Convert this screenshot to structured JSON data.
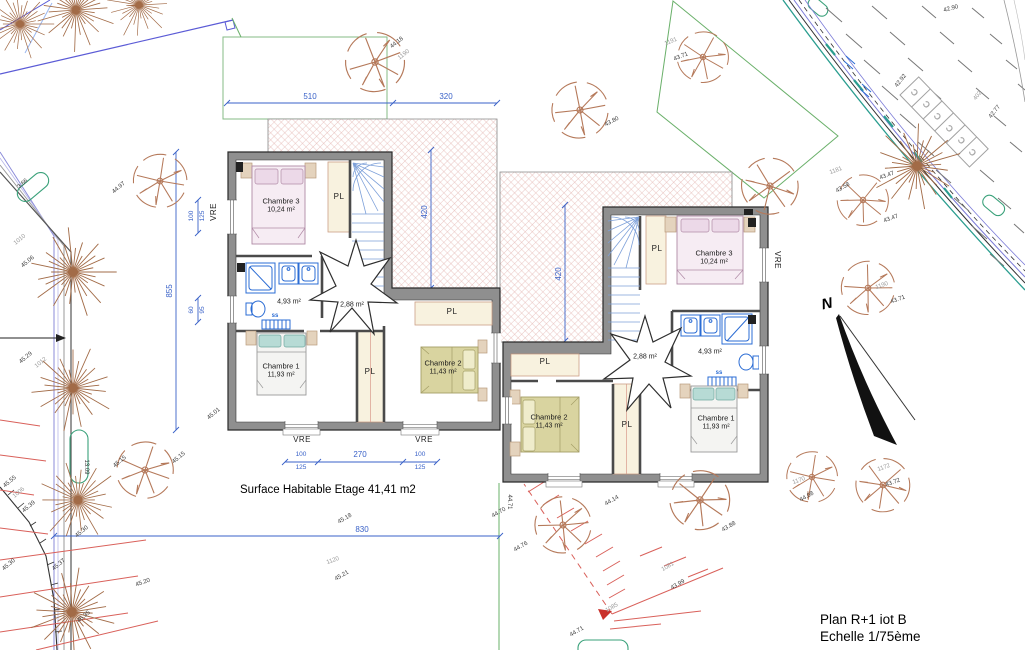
{
  "meta": {
    "title_line1": "Plan R+1 iot B",
    "title_line2": "Echelle 1/75ème",
    "surface_note": "Surface Habitable Etage 41,41 m2"
  },
  "colors": {
    "dimension_blue": "#3a62c8",
    "fixture_blue": "#2b6cd4",
    "wall_gray": "#8f8f8f",
    "tree_brown": "#a26b47",
    "hatch_red": "#d4908a",
    "boundary_green": "#6ab06a",
    "boundary_blue": "#5b5bd6",
    "slope_red": "#d9605a",
    "closet_cream": "#f8f2df"
  },
  "labels": [
    {
      "t": "510",
      "x": 310,
      "y": 97,
      "c": "dim",
      "n": "dim-510"
    },
    {
      "t": "320",
      "x": 446,
      "y": 97,
      "c": "dim",
      "n": "dim-320"
    },
    {
      "t": "420",
      "x": 425,
      "y": 212,
      "r": -90,
      "c": "dim",
      "n": "dim-420-left"
    },
    {
      "t": "420",
      "x": 559,
      "y": 274,
      "r": -90,
      "c": "dim",
      "n": "dim-420-right"
    },
    {
      "t": "855",
      "x": 170,
      "y": 291,
      "r": -90,
      "c": "dim",
      "n": "dim-855"
    },
    {
      "t": "830",
      "x": 362,
      "y": 530,
      "c": "dim",
      "n": "dim-830"
    },
    {
      "t": "270",
      "x": 360,
      "y": 455,
      "c": "dim",
      "n": "dim-270"
    },
    {
      "t": "100",
      "x": 301,
      "y": 455,
      "c": "dimsm"
    },
    {
      "t": "125",
      "x": 301,
      "y": 468,
      "c": "dimsm"
    },
    {
      "t": "100",
      "x": 420,
      "y": 455,
      "c": "dimsm"
    },
    {
      "t": "125",
      "x": 420,
      "y": 468,
      "c": "dimsm"
    },
    {
      "t": "100",
      "x": 192,
      "y": 216,
      "r": -90,
      "c": "dimsm"
    },
    {
      "t": "125",
      "x": 203,
      "y": 216,
      "r": -90,
      "c": "dimsm"
    },
    {
      "t": "60",
      "x": 192,
      "y": 310,
      "r": -90,
      "c": "dimsm"
    },
    {
      "t": "95",
      "x": 203,
      "y": 310,
      "r": -90,
      "c": "dimsm"
    },
    {
      "t": "VRE",
      "x": 214,
      "y": 212,
      "r": -90,
      "c": "vre",
      "n": "window-label-vre"
    },
    {
      "t": "VRE",
      "x": 302,
      "y": 440,
      "c": "vre",
      "n": "window-label-vre"
    },
    {
      "t": "VRE",
      "x": 424,
      "y": 440,
      "c": "vre",
      "n": "window-label-vre"
    },
    {
      "t": "VRE",
      "x": 777,
      "y": 260,
      "r": 90,
      "c": "vre",
      "n": "window-label-vre"
    },
    {
      "t": "Chambre 3",
      "x": 281,
      "y": 201,
      "c": "room",
      "n": "room-name"
    },
    {
      "t": "10,24 m²",
      "x": 281,
      "y": 210,
      "c": "area",
      "n": "room-area"
    },
    {
      "t": "Chambre 1",
      "x": 281,
      "y": 366,
      "c": "room",
      "n": "room-name"
    },
    {
      "t": "11,93 m²",
      "x": 281,
      "y": 375,
      "c": "area",
      "n": "room-area"
    },
    {
      "t": "Chambre 2",
      "x": 443,
      "y": 363,
      "c": "room",
      "n": "room-name"
    },
    {
      "t": "11,43 m²",
      "x": 443,
      "y": 372,
      "c": "area",
      "n": "room-area"
    },
    {
      "t": "4,93 m²",
      "x": 289,
      "y": 302,
      "c": "area",
      "n": "room-area"
    },
    {
      "t": "2,88 m²",
      "x": 352,
      "y": 305,
      "c": "area",
      "n": "room-area"
    },
    {
      "t": "ss",
      "x": 275,
      "y": 316,
      "c": "ss",
      "n": "towel-radiator-label"
    },
    {
      "t": "PL",
      "x": 339,
      "y": 197,
      "c": "pl",
      "n": "closet-label"
    },
    {
      "t": "PL",
      "x": 452,
      "y": 312,
      "c": "pl",
      "n": "closet-label"
    },
    {
      "t": "PL",
      "x": 370,
      "y": 372,
      "c": "pl",
      "n": "closet-label"
    },
    {
      "t": "Chambre 3",
      "x": 714,
      "y": 253,
      "c": "room",
      "n": "room-name"
    },
    {
      "t": "10,24 m²",
      "x": 714,
      "y": 262,
      "c": "area",
      "n": "room-area"
    },
    {
      "t": "Chambre 2",
      "x": 549,
      "y": 417,
      "c": "room",
      "n": "room-name"
    },
    {
      "t": "11,43 m²",
      "x": 549,
      "y": 426,
      "c": "area",
      "n": "room-area"
    },
    {
      "t": "Chambre 1",
      "x": 716,
      "y": 418,
      "c": "room",
      "n": "room-name"
    },
    {
      "t": "11,93 m²",
      "x": 716,
      "y": 427,
      "c": "area",
      "n": "room-area"
    },
    {
      "t": "4,93 m²",
      "x": 710,
      "y": 352,
      "c": "area",
      "n": "room-area"
    },
    {
      "t": "2,88 m²",
      "x": 645,
      "y": 357,
      "c": "area",
      "n": "room-area"
    },
    {
      "t": "ss",
      "x": 719,
      "y": 373,
      "c": "ss",
      "n": "towel-radiator-label"
    },
    {
      "t": "PL",
      "x": 657,
      "y": 249,
      "c": "pl",
      "n": "closet-label"
    },
    {
      "t": "PL",
      "x": 545,
      "y": 362,
      "c": "pl",
      "n": "closet-label"
    },
    {
      "t": "PL",
      "x": 627,
      "y": 425,
      "c": "pl",
      "n": "closet-label"
    },
    {
      "t": "44.18",
      "x": 397,
      "y": 43,
      "r": -38,
      "c": "spot"
    },
    {
      "t": "1190",
      "x": 404,
      "y": 55,
      "r": -38,
      "c": "spotg"
    },
    {
      "t": "43.71",
      "x": 681,
      "y": 57,
      "r": -22,
      "c": "spot"
    },
    {
      "t": "1191",
      "x": 671,
      "y": 42,
      "r": -22,
      "c": "spotg"
    },
    {
      "t": "43.80",
      "x": 612,
      "y": 122,
      "r": -28,
      "c": "spot"
    },
    {
      "t": "42.90",
      "x": 951,
      "y": 9,
      "r": -15,
      "c": "spot"
    },
    {
      "t": "42.92",
      "x": 901,
      "y": 81,
      "r": -52,
      "c": "spot"
    },
    {
      "t": "402",
      "x": 978,
      "y": 96,
      "r": -52,
      "c": "spotg"
    },
    {
      "t": "42.77",
      "x": 995,
      "y": 112,
      "r": -52,
      "c": "spot"
    },
    {
      "t": "1181",
      "x": 836,
      "y": 171,
      "r": -20,
      "c": "spotg"
    },
    {
      "t": "43.47",
      "x": 887,
      "y": 176,
      "r": -20,
      "c": "spot"
    },
    {
      "t": "43.58",
      "x": 843,
      "y": 188,
      "r": -30,
      "c": "spot"
    },
    {
      "t": "43.47",
      "x": 891,
      "y": 219,
      "r": -20,
      "c": "spot"
    },
    {
      "t": "44.97",
      "x": 119,
      "y": 188,
      "r": -40,
      "c": "spot"
    },
    {
      "t": "1190",
      "x": 882,
      "y": 286,
      "r": -20,
      "c": "spotg"
    },
    {
      "t": "43.71",
      "x": 898,
      "y": 300,
      "r": -20,
      "c": "spot"
    },
    {
      "t": "1010",
      "x": 20,
      "y": 240,
      "r": -40,
      "c": "spotg"
    },
    {
      "t": "45.06",
      "x": 28,
      "y": 262,
      "r": -40,
      "c": "spot"
    },
    {
      "t": "45.29",
      "x": 26,
      "y": 358,
      "r": -40,
      "c": "spot"
    },
    {
      "t": "1012",
      "x": 41,
      "y": 363,
      "r": -40,
      "c": "spotg"
    },
    {
      "t": "45.01",
      "x": 214,
      "y": 414,
      "r": -40,
      "c": "spot"
    },
    {
      "t": "3.66",
      "x": 23,
      "y": 184,
      "r": -42,
      "c": "spot"
    },
    {
      "t": "45.55",
      "x": 10,
      "y": 482,
      "r": -40,
      "c": "spot"
    },
    {
      "t": "1006",
      "x": 19,
      "y": 493,
      "r": -40,
      "c": "spotg"
    },
    {
      "t": "45.39",
      "x": 29,
      "y": 507,
      "r": -40,
      "c": "spot"
    },
    {
      "t": "45.15",
      "x": 120,
      "y": 462,
      "r": -40,
      "c": "spot"
    },
    {
      "t": "45.15",
      "x": 179,
      "y": 458,
      "r": -40,
      "c": "spot"
    },
    {
      "t": "13.09",
      "x": 86,
      "y": 467,
      "r": 90,
      "c": "spot"
    },
    {
      "t": "45.30",
      "x": 82,
      "y": 532,
      "r": -40,
      "c": "spot"
    },
    {
      "t": "45.37",
      "x": 59,
      "y": 565,
      "r": -40,
      "c": "spot"
    },
    {
      "t": "45.30",
      "x": 9,
      "y": 565,
      "r": -40,
      "c": "spot"
    },
    {
      "t": "45.20",
      "x": 143,
      "y": 583,
      "r": -20,
      "c": "spot"
    },
    {
      "t": "45.35",
      "x": 84,
      "y": 617,
      "r": -40,
      "c": "spot"
    },
    {
      "t": "45.18",
      "x": 345,
      "y": 519,
      "r": -30,
      "c": "spot"
    },
    {
      "t": "44.70",
      "x": 499,
      "y": 513,
      "r": -30,
      "c": "spot"
    },
    {
      "t": "44.71",
      "x": 509,
      "y": 502,
      "r": 90,
      "c": "spot"
    },
    {
      "t": "1120",
      "x": 333,
      "y": 561,
      "r": -20,
      "c": "spotg"
    },
    {
      "t": "45.21",
      "x": 342,
      "y": 576,
      "r": -30,
      "c": "spot"
    },
    {
      "t": "44.76",
      "x": 521,
      "y": 547,
      "r": -30,
      "c": "spot"
    },
    {
      "t": "44.14",
      "x": 612,
      "y": 501,
      "r": -30,
      "c": "spot"
    },
    {
      "t": "43.88",
      "x": 729,
      "y": 527,
      "r": -30,
      "c": "spot"
    },
    {
      "t": "1081",
      "x": 668,
      "y": 567,
      "r": -30,
      "c": "spotg"
    },
    {
      "t": "43.99",
      "x": 678,
      "y": 585,
      "r": -30,
      "c": "spot"
    },
    {
      "t": "1085",
      "x": 612,
      "y": 608,
      "r": -30,
      "c": "spotg"
    },
    {
      "t": "44.71",
      "x": 577,
      "y": 632,
      "r": -30,
      "c": "spot"
    },
    {
      "t": "1170",
      "x": 799,
      "y": 481,
      "r": -20,
      "c": "spotg"
    },
    {
      "t": "44.08",
      "x": 807,
      "y": 497,
      "r": -30,
      "c": "spot"
    },
    {
      "t": "1172",
      "x": 884,
      "y": 468,
      "r": -20,
      "c": "spotg"
    },
    {
      "t": "43.72",
      "x": 893,
      "y": 483,
      "r": -20,
      "c": "spot"
    },
    {
      "t": "C",
      "x": 915,
      "y": 92,
      "r": -134,
      "c": "park",
      "n": "parking-stall-letter"
    },
    {
      "t": "C",
      "x": 927,
      "y": 104,
      "r": -134,
      "c": "park",
      "n": "parking-stall-letter"
    },
    {
      "t": "C",
      "x": 938,
      "y": 116,
      "r": -134,
      "c": "park",
      "n": "parking-stall-letter"
    },
    {
      "t": "C",
      "x": 950,
      "y": 128,
      "r": -134,
      "c": "park",
      "n": "parking-stall-letter"
    },
    {
      "t": "C",
      "x": 962,
      "y": 140,
      "r": -134,
      "c": "park",
      "n": "parking-stall-letter"
    },
    {
      "t": "C",
      "x": 973,
      "y": 152,
      "r": -134,
      "c": "park",
      "n": "parking-stall-letter"
    },
    {
      "t": "N",
      "x": 827,
      "y": 304,
      "r": -12,
      "c": "north",
      "n": "north-label"
    }
  ]
}
